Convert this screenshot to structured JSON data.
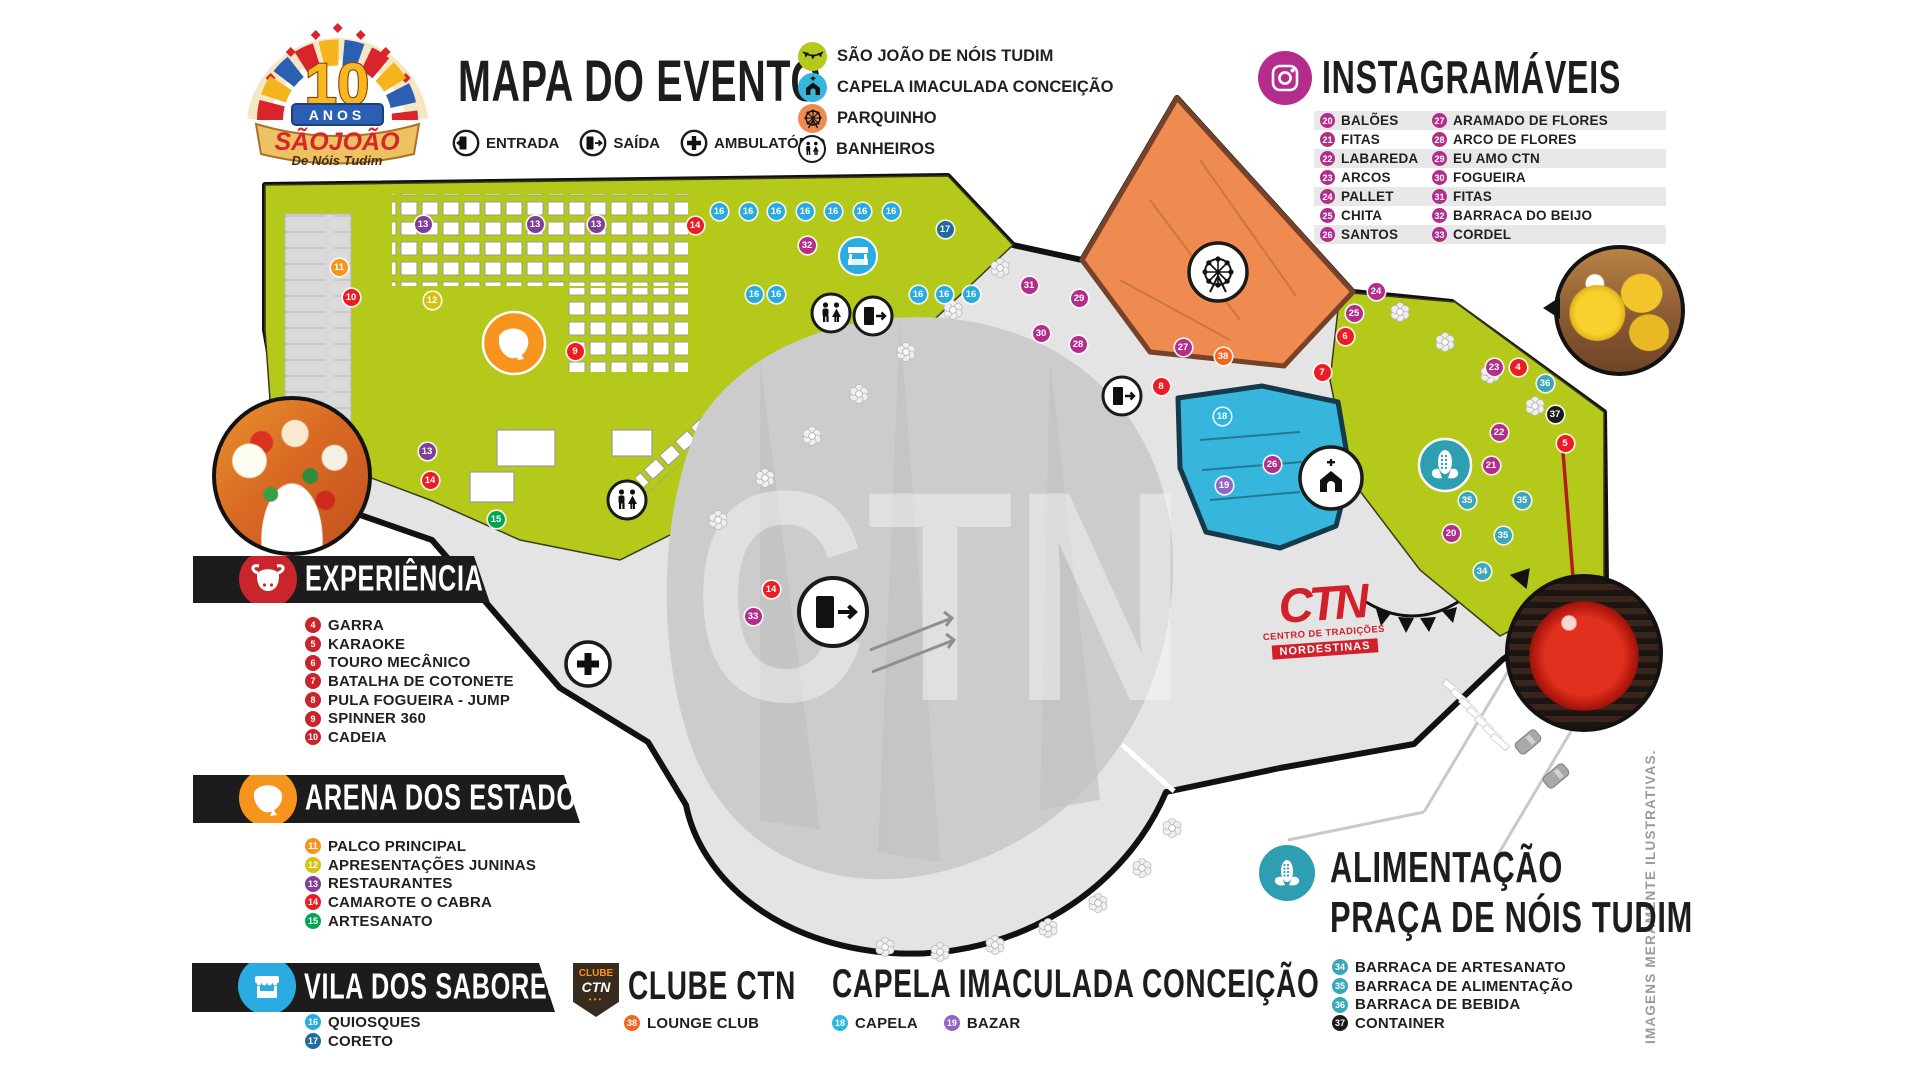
{
  "logo": {
    "num": "10",
    "anos": "ANOS",
    "name": "SÃOJOÃO",
    "tagline": "De Nóis Tudim"
  },
  "header": {
    "title": "MAPA DO EVENTO",
    "entry_legend": [
      {
        "label": "ENTRADA",
        "icon": "door-enter-icon"
      },
      {
        "label": "SAÍDA",
        "icon": "door-exit-icon"
      },
      {
        "label": "AMBULATÓRIO",
        "icon": "medical-cross-icon"
      }
    ]
  },
  "poi_legend": [
    {
      "label": "SÃO JOÃO DE NÓIS TUDIM",
      "color": "#b5c91a",
      "icon": "bunting-flags-icon"
    },
    {
      "label": "CAPELA IMACULADA CONCEIÇÃO",
      "color": "#36b6dc",
      "icon": "church-icon"
    },
    {
      "label": "PARQUINHO",
      "color": "#ef8a50",
      "icon": "ferris-wheel-icon"
    },
    {
      "label": "BANHEIROS",
      "color": "#ffffff",
      "icon": "restroom-icon"
    }
  ],
  "instagramaveis": {
    "title": "INSTAGRAMÁVEIS",
    "accent": "#b42d8c",
    "items_col1": [
      {
        "num": "20",
        "label": "BALÕES"
      },
      {
        "num": "21",
        "label": "FITAS"
      },
      {
        "num": "22",
        "label": "LABAREDA"
      },
      {
        "num": "23",
        "label": "ARCOS"
      },
      {
        "num": "24",
        "label": "PALLET"
      },
      {
        "num": "25",
        "label": "CHITA"
      },
      {
        "num": "26",
        "label": "SANTOS"
      }
    ],
    "items_col2": [
      {
        "num": "27",
        "label": "ARAMADO DE FLORES"
      },
      {
        "num": "28",
        "label": "ARCO DE FLORES"
      },
      {
        "num": "29",
        "label": "EU AMO CTN"
      },
      {
        "num": "30",
        "label": "FOGUEIRA"
      },
      {
        "num": "31",
        "label": "FITAS"
      },
      {
        "num": "32",
        "label": "BARRACA DO BEIJO"
      },
      {
        "num": "33",
        "label": "CORDEL"
      }
    ]
  },
  "sections": {
    "experiencias": {
      "title": "EXPERIÊNCIAS",
      "icon": "bull-icon",
      "icon_bg": "#c9252c",
      "items": [
        {
          "num": "4",
          "label": "GARRA",
          "color": "#cc2229"
        },
        {
          "num": "5",
          "label": "KARAOKE",
          "color": "#cc2229"
        },
        {
          "num": "6",
          "label": "TOURO MECÂNICO",
          "color": "#cc2229"
        },
        {
          "num": "7",
          "label": "BATALHA DE COTONETE",
          "color": "#cc2229"
        },
        {
          "num": "8",
          "label": "PULA FOGUEIRA - JUMP",
          "color": "#cc2229"
        },
        {
          "num": "9",
          "label": "SPINNER 360",
          "color": "#cc2229"
        },
        {
          "num": "10",
          "label": "CADEIA",
          "color": "#cc2229"
        }
      ]
    },
    "arena": {
      "title": "ARENA DOS ESTADOS",
      "icon": "brazil-map-icon",
      "icon_bg": "#f7941e",
      "items": [
        {
          "num": "11",
          "label": "PALCO PRINCIPAL",
          "color": "#f7941e"
        },
        {
          "num": "12",
          "label": "APRESENTAÇÕES JUNINAS",
          "color": "#d4c211"
        },
        {
          "num": "13",
          "label": "RESTAURANTES",
          "color": "#7f3f98"
        },
        {
          "num": "14",
          "label": "CAMAROTE O CABRA",
          "color": "#ed1c24"
        },
        {
          "num": "15",
          "label": "ARTESANATO",
          "color": "#00a651"
        }
      ]
    },
    "vila": {
      "title": "VILA DOS SABORES",
      "icon": "kiosk-icon",
      "icon_bg": "#2aabe2",
      "items": [
        {
          "num": "16",
          "label": "QUIOSQUES",
          "color": "#29abe2"
        },
        {
          "num": "17",
          "label": "CORETO",
          "color": "#1f6b9e"
        }
      ]
    },
    "clube": {
      "title": "CLUBE CTN",
      "badge_top": "CLUBE",
      "badge_mid": "CTN",
      "badge_dots": "•••",
      "items": [
        {
          "num": "38",
          "label": "LOUNGE CLUB",
          "color": "#f26522"
        }
      ]
    },
    "capela": {
      "title": "CAPELA IMACULADA CONCEIÇÃO",
      "items": [
        {
          "num": "18",
          "label": "CAPELA",
          "color": "#2bb8e0"
        },
        {
          "num": "19",
          "label": "BAZAR",
          "color": "#9164c8"
        }
      ]
    },
    "alimentacao": {
      "title_line1": "ALIMENTAÇÃO",
      "title_line2": "PRAÇA DE NÓIS TUDIM",
      "icon": "corn-icon",
      "icon_bg": "#2e9fb0",
      "items": [
        {
          "num": "34",
          "label": "BARRACA DE ARTESANATO",
          "color": "#3ba7b9"
        },
        {
          "num": "35",
          "label": "BARRACA DE ALIMENTAÇÃO",
          "color": "#3ba7b9"
        },
        {
          "num": "36",
          "label": "BARRACA DE BEBIDA",
          "color": "#3ba7b9"
        },
        {
          "num": "37",
          "label": "CONTAINER",
          "color": "#1a1a1a"
        }
      ]
    }
  },
  "map": {
    "watermark": "CTN",
    "ctn_logo": {
      "word": "CTN",
      "sub": "CENTRO DE TRADIÇÕES",
      "band": "NORDESTINAS"
    },
    "colors": {
      "green": "#b5c91a",
      "orange": "#ef8a50",
      "orange_border": "#76422a",
      "blue": "#36b6dc",
      "blue_border": "#173a4a",
      "gray": "#e4e4e4",
      "arena": "#cccccc",
      "outline": "#111111"
    },
    "markers": [
      {
        "n": "13",
        "x": 423,
        "y": 224,
        "c": "#7f3f98"
      },
      {
        "n": "13",
        "x": 535,
        "y": 224,
        "c": "#7f3f98"
      },
      {
        "n": "13",
        "x": 596,
        "y": 224,
        "c": "#7f3f98"
      },
      {
        "n": "14",
        "x": 695,
        "y": 225,
        "c": "#ed1c24"
      },
      {
        "n": "16",
        "x": 719,
        "y": 211,
        "c": "#29abe2"
      },
      {
        "n": "16",
        "x": 748,
        "y": 211,
        "c": "#29abe2"
      },
      {
        "n": "16",
        "x": 776,
        "y": 211,
        "c": "#29abe2"
      },
      {
        "n": "16",
        "x": 805,
        "y": 211,
        "c": "#29abe2"
      },
      {
        "n": "16",
        "x": 833,
        "y": 211,
        "c": "#29abe2"
      },
      {
        "n": "16",
        "x": 862,
        "y": 211,
        "c": "#29abe2"
      },
      {
        "n": "16",
        "x": 891,
        "y": 211,
        "c": "#29abe2"
      },
      {
        "n": "17",
        "x": 945,
        "y": 229,
        "c": "#1f6b9e"
      },
      {
        "n": "32",
        "x": 807,
        "y": 245,
        "c": "#b42d8c"
      },
      {
        "n": "16",
        "x": 754,
        "y": 294,
        "c": "#29abe2"
      },
      {
        "n": "16",
        "x": 776,
        "y": 294,
        "c": "#29abe2"
      },
      {
        "n": "16",
        "x": 918,
        "y": 294,
        "c": "#29abe2"
      },
      {
        "n": "16",
        "x": 944,
        "y": 294,
        "c": "#29abe2"
      },
      {
        "n": "16",
        "x": 971,
        "y": 294,
        "c": "#29abe2"
      },
      {
        "n": "11",
        "x": 339,
        "y": 267,
        "c": "#f7941e"
      },
      {
        "n": "10",
        "x": 351,
        "y": 297,
        "c": "#ed1c24"
      },
      {
        "n": "12",
        "x": 432,
        "y": 300,
        "c": "#d4c211"
      },
      {
        "n": "9",
        "x": 575,
        "y": 351,
        "c": "#ed1c24"
      },
      {
        "n": "13",
        "x": 427,
        "y": 451,
        "c": "#7f3f98"
      },
      {
        "n": "14",
        "x": 430,
        "y": 480,
        "c": "#ed1c24"
      },
      {
        "n": "15",
        "x": 496,
        "y": 519,
        "c": "#00a651"
      },
      {
        "n": "14",
        "x": 771,
        "y": 589,
        "c": "#ed1c24"
      },
      {
        "n": "33",
        "x": 753,
        "y": 616,
        "c": "#b42d8c"
      },
      {
        "n": "31",
        "x": 1029,
        "y": 285,
        "c": "#b42d8c"
      },
      {
        "n": "29",
        "x": 1079,
        "y": 298,
        "c": "#b42d8c"
      },
      {
        "n": "30",
        "x": 1041,
        "y": 333,
        "c": "#b42d8c"
      },
      {
        "n": "28",
        "x": 1078,
        "y": 344,
        "c": "#b42d8c"
      },
      {
        "n": "27",
        "x": 1183,
        "y": 347,
        "c": "#b42d8c"
      },
      {
        "n": "38",
        "x": 1223,
        "y": 356,
        "c": "#f26522"
      },
      {
        "n": "8",
        "x": 1161,
        "y": 386,
        "c": "#ed1c24"
      },
      {
        "n": "18",
        "x": 1222,
        "y": 416,
        "c": "#2bb8e0"
      },
      {
        "n": "26",
        "x": 1272,
        "y": 464,
        "c": "#b42d8c"
      },
      {
        "n": "19",
        "x": 1224,
        "y": 485,
        "c": "#9164c8"
      },
      {
        "n": "24",
        "x": 1376,
        "y": 291,
        "c": "#b42d8c"
      },
      {
        "n": "25",
        "x": 1354,
        "y": 313,
        "c": "#b42d8c"
      },
      {
        "n": "6",
        "x": 1345,
        "y": 336,
        "c": "#ed1c24"
      },
      {
        "n": "7",
        "x": 1322,
        "y": 372,
        "c": "#ed1c24"
      },
      {
        "n": "23",
        "x": 1494,
        "y": 367,
        "c": "#b42d8c"
      },
      {
        "n": "4",
        "x": 1518,
        "y": 367,
        "c": "#ed1c24"
      },
      {
        "n": "36",
        "x": 1545,
        "y": 383,
        "c": "#3ba7b9"
      },
      {
        "n": "37",
        "x": 1555,
        "y": 414,
        "c": "#1a1a1a"
      },
      {
        "n": "22",
        "x": 1499,
        "y": 432,
        "c": "#b42d8c"
      },
      {
        "n": "21",
        "x": 1491,
        "y": 465,
        "c": "#b42d8c"
      },
      {
        "n": "5",
        "x": 1565,
        "y": 443,
        "c": "#ed1c24"
      },
      {
        "n": "35",
        "x": 1467,
        "y": 500,
        "c": "#3ba7b9"
      },
      {
        "n": "35",
        "x": 1522,
        "y": 500,
        "c": "#3ba7b9"
      },
      {
        "n": "20",
        "x": 1451,
        "y": 533,
        "c": "#b42d8c"
      },
      {
        "n": "35",
        "x": 1503,
        "y": 535,
        "c": "#3ba7b9"
      },
      {
        "n": "34",
        "x": 1482,
        "y": 571,
        "c": "#3ba7b9"
      }
    ]
  },
  "disclaimer": "IMAGENS MERAMENTE ILUSTRATIVAS."
}
